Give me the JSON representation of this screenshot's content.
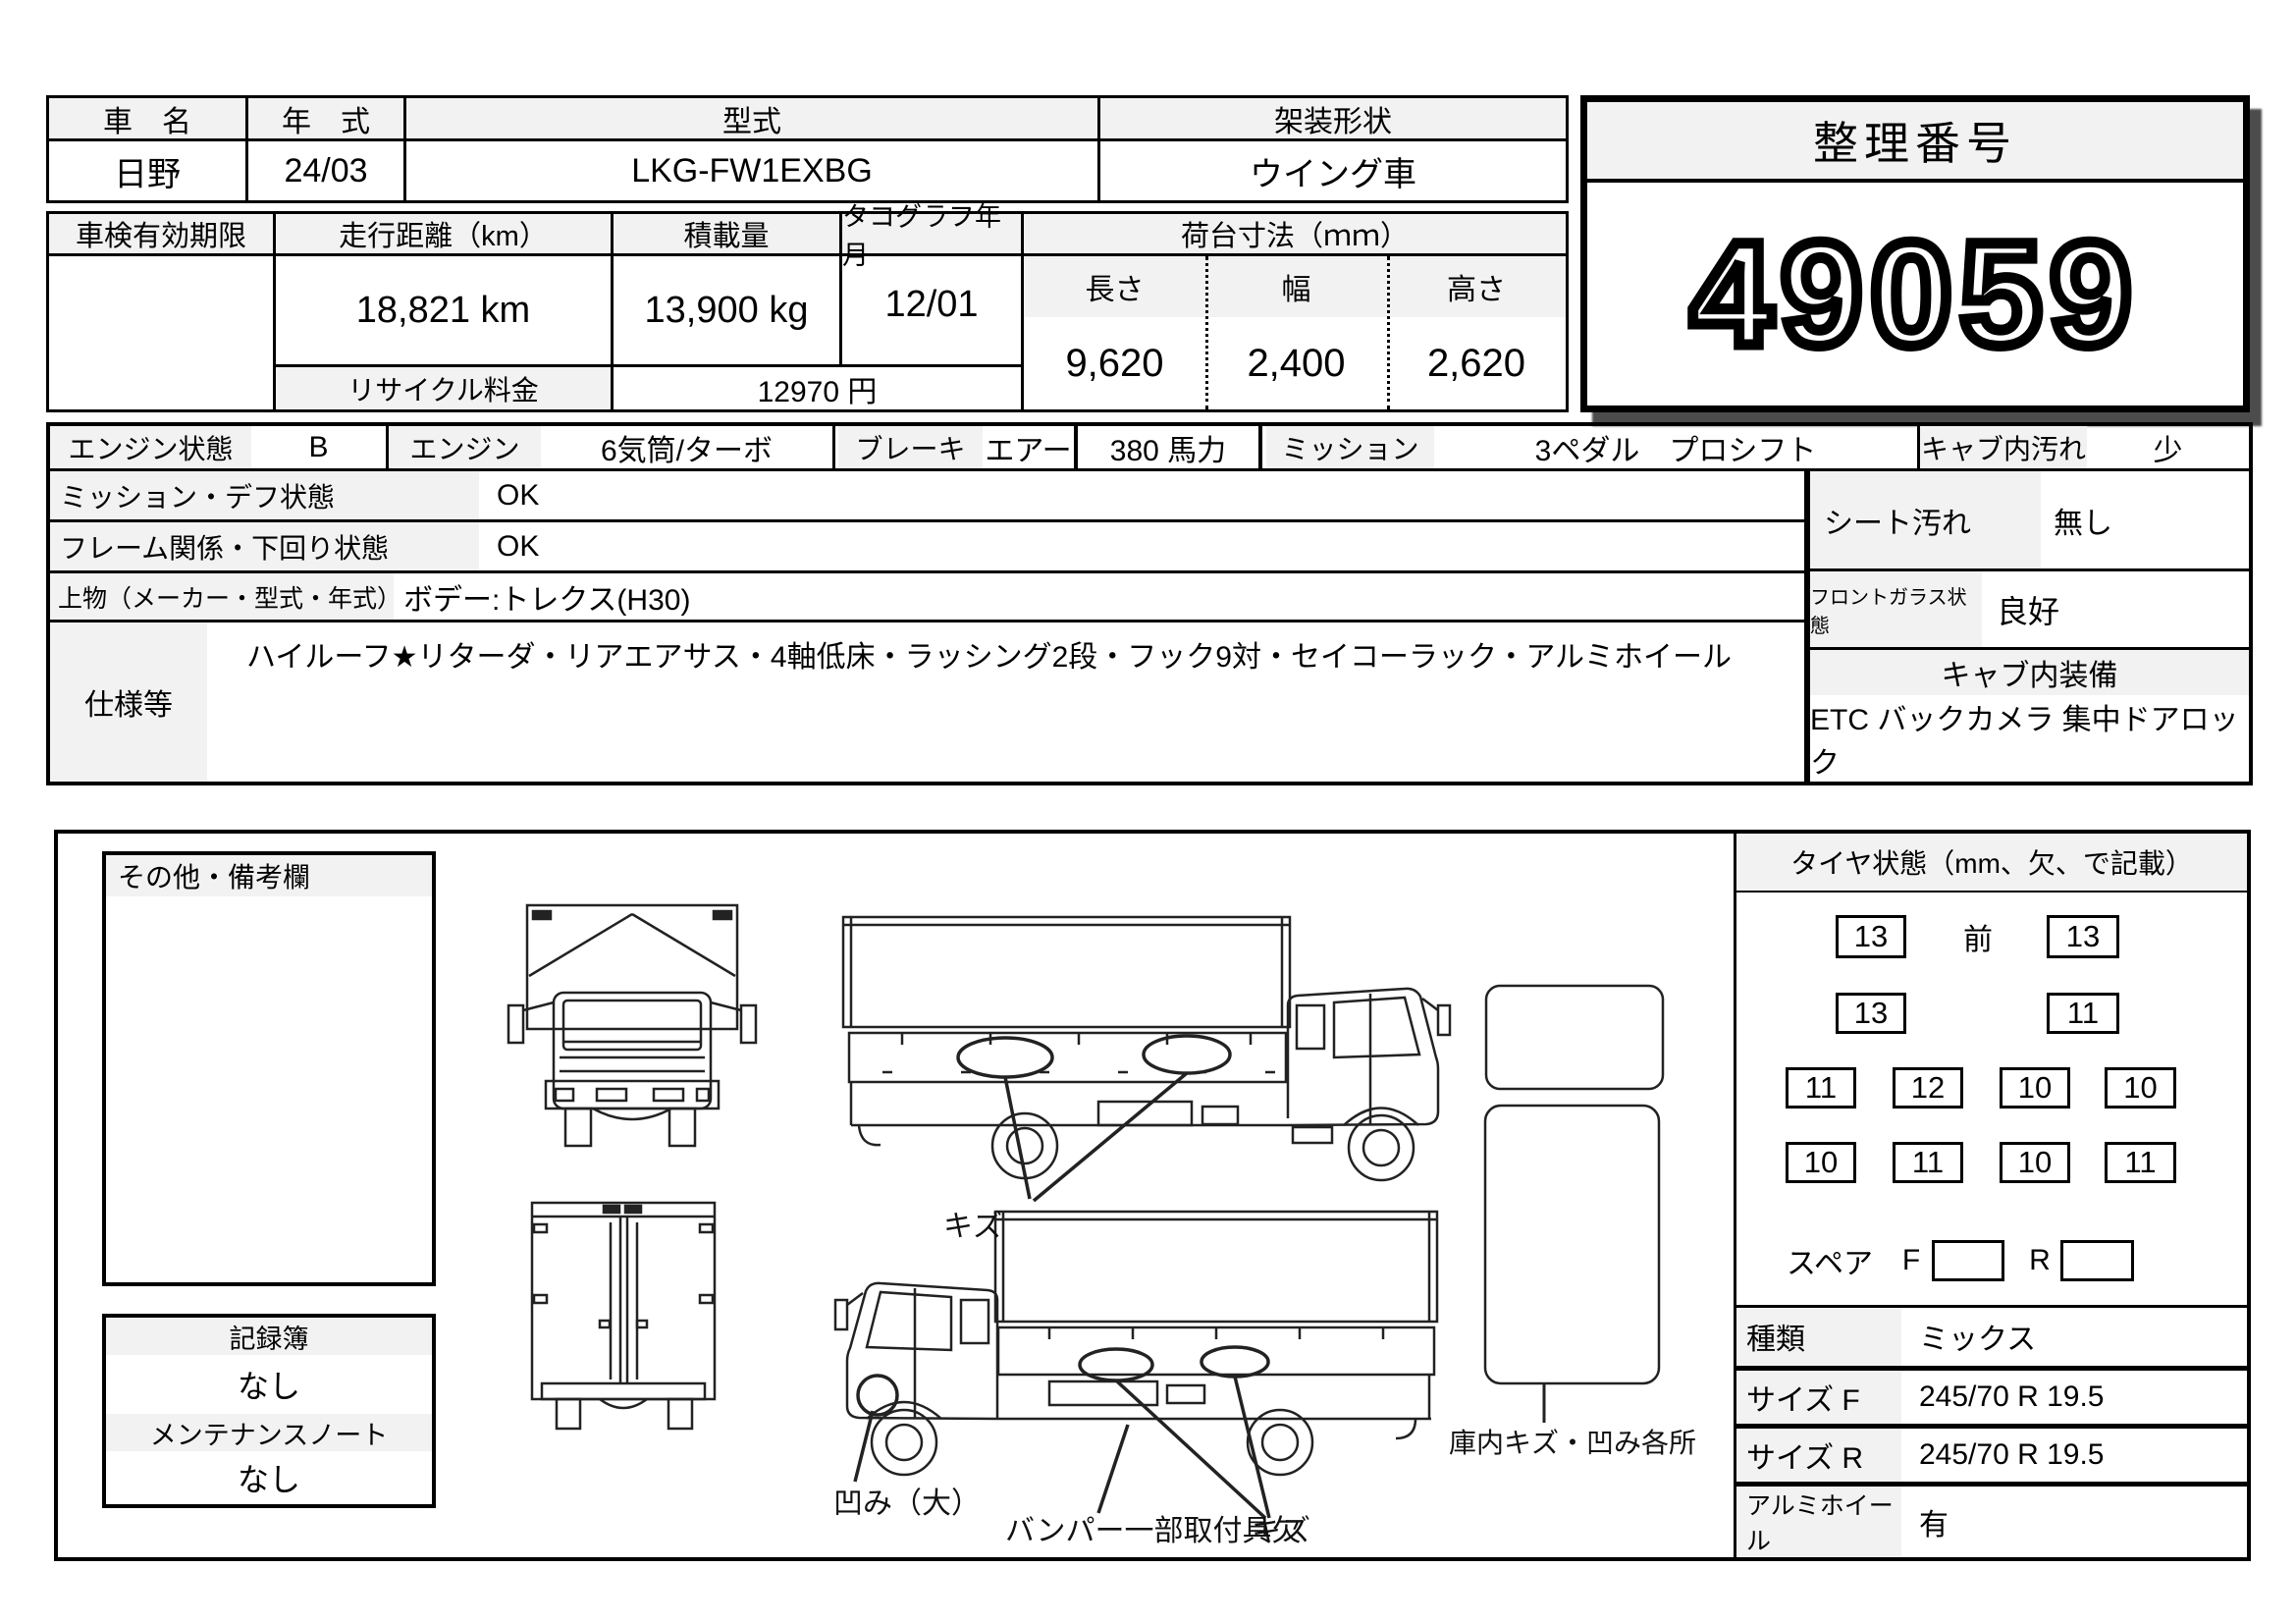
{
  "title_table": {
    "headers": {
      "name": "車　名",
      "year": "年　式",
      "model": "型式",
      "body": "架装形状"
    },
    "values": {
      "name": "日野",
      "year": "24/03",
      "model": "LKG-FW1EXBG",
      "body": "ウイング車"
    }
  },
  "ref": {
    "label": "整理番号",
    "number": "49059"
  },
  "detail": {
    "headers": {
      "inspection": "車検有効期限",
      "mileage": "走行距離（km）",
      "payload": "積載量",
      "tacho": "タコグラフ年月",
      "bed": "荷台寸法（ｍｍ）"
    },
    "values": {
      "inspection": "",
      "mileage": "18,821 km",
      "payload": "13,900 kg",
      "tacho": "12/01"
    },
    "recycle": {
      "label": "リサイクル料金",
      "value": "12970 円"
    },
    "bed": {
      "cols": [
        {
          "label": "長さ",
          "value": "9,620"
        },
        {
          "label": "幅",
          "value": "2,400"
        },
        {
          "label": "高さ",
          "value": "2,620"
        }
      ]
    }
  },
  "condition": {
    "engine_state": {
      "label": "エンジン状態",
      "value": "B"
    },
    "engine": {
      "label": "エンジン",
      "value": "6気筒/ターボ"
    },
    "brake": {
      "label": "ブレーキ",
      "value": "エアー"
    },
    "horsepower": "380 馬力",
    "mission": {
      "label": "ミッション",
      "value": "3ペダル　プロシフト"
    },
    "cab_dirt": {
      "label": "キャブ内汚れ",
      "value": "少"
    },
    "mission_diff": {
      "label": "ミッション・デフ状態",
      "value": "OK"
    },
    "frame": {
      "label": "フレーム関係・下回り状態",
      "value": "OK"
    },
    "body_maker": {
      "label": "上物（メーカー・型式・年式）",
      "value": "ボデー:トレクス(H30)"
    },
    "spec": {
      "label": "仕様等",
      "value": "ハイルーフ★リターダ・リアエアサス・4軸低床・ラッシング2段・フック9対・セイコーラック・アルミホイール"
    },
    "seat": {
      "label": "シート汚れ",
      "value": "無し"
    },
    "windshield": {
      "label": "フロントガラス状態",
      "value": "良好"
    },
    "cab_equip": {
      "header": "キャブ内装備",
      "value": "ETC バックカメラ 集中ドアロック"
    }
  },
  "bottom": {
    "remarks_label": "その他・備考欄",
    "records": {
      "book_label": "記録簿",
      "book_value": "なし",
      "maint_label": "メンテナンスノート",
      "maint_value": "なし"
    }
  },
  "tires": {
    "header": "タイヤ状態（mm、欠、で記載）",
    "front_label": "前",
    "row1": [
      "13",
      "13"
    ],
    "row2": [
      "13",
      "11"
    ],
    "row3": [
      "11",
      "12",
      "10",
      "10"
    ],
    "row4": [
      "10",
      "11",
      "10",
      "11"
    ],
    "spare": {
      "label": "スペア",
      "f": "F",
      "r": "R"
    },
    "type": {
      "label": "種類",
      "value": "ミックス"
    },
    "size_f": {
      "label": "サイズ F",
      "value": "245/70 R 19.5"
    },
    "size_r": {
      "label": "サイズ R",
      "value": "245/70 R 19.5"
    },
    "alumi": {
      "label": "アルミホイール",
      "value": "有"
    }
  },
  "diagram": {
    "scratch_top": "キズ",
    "dent": "凹み（大）",
    "bumper_missing": "バンパー一部取付具欠",
    "scratch_bottom": "キズ",
    "cargo_interior": "庫内キズ・凹み各所"
  }
}
